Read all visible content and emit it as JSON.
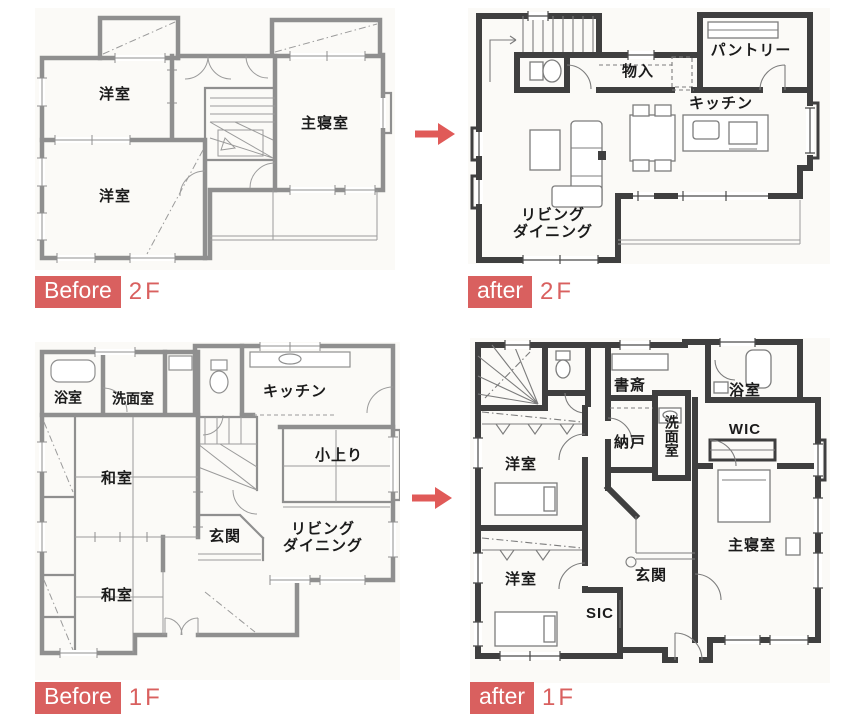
{
  "accent": {
    "red": "#d9605f"
  },
  "plans": {
    "before2f": {
      "badge": "Before",
      "floor": "2F",
      "rooms": {
        "yoshitsu_top": "洋室",
        "shushinshitsu": "主寝室",
        "yoshitsu_bottom": "洋室"
      }
    },
    "after2f": {
      "badge": "after",
      "floor": "2F",
      "rooms": {
        "monoire": "物入",
        "pantry": "パントリー",
        "kitchen": "キッチン",
        "living_line1": "リビング",
        "living_line2": "ダイニング"
      }
    },
    "before1f": {
      "badge": "Before",
      "floor": "1F",
      "rooms": {
        "yokushitsu": "浴室",
        "senmenshitsu": "洗面室",
        "kitchen": "キッチン",
        "washitsu_mid": "和室",
        "koagari": "小上り",
        "genkan": "玄関",
        "living_line1": "リビング",
        "living_line2": "ダイニング",
        "washitsu_bottom": "和室"
      }
    },
    "after1f": {
      "badge": "after",
      "floor": "1F",
      "rooms": {
        "shosai": "書斎",
        "yokushitsu": "浴室",
        "nando": "納戸",
        "senmenshitsu": "洗面室",
        "wic": "WIC",
        "yoshitsu_top": "洋室",
        "shushinshitsu": "主寝室",
        "yoshitsu_bottom": "洋室",
        "genkan": "玄関",
        "sic": "SIC"
      }
    }
  }
}
